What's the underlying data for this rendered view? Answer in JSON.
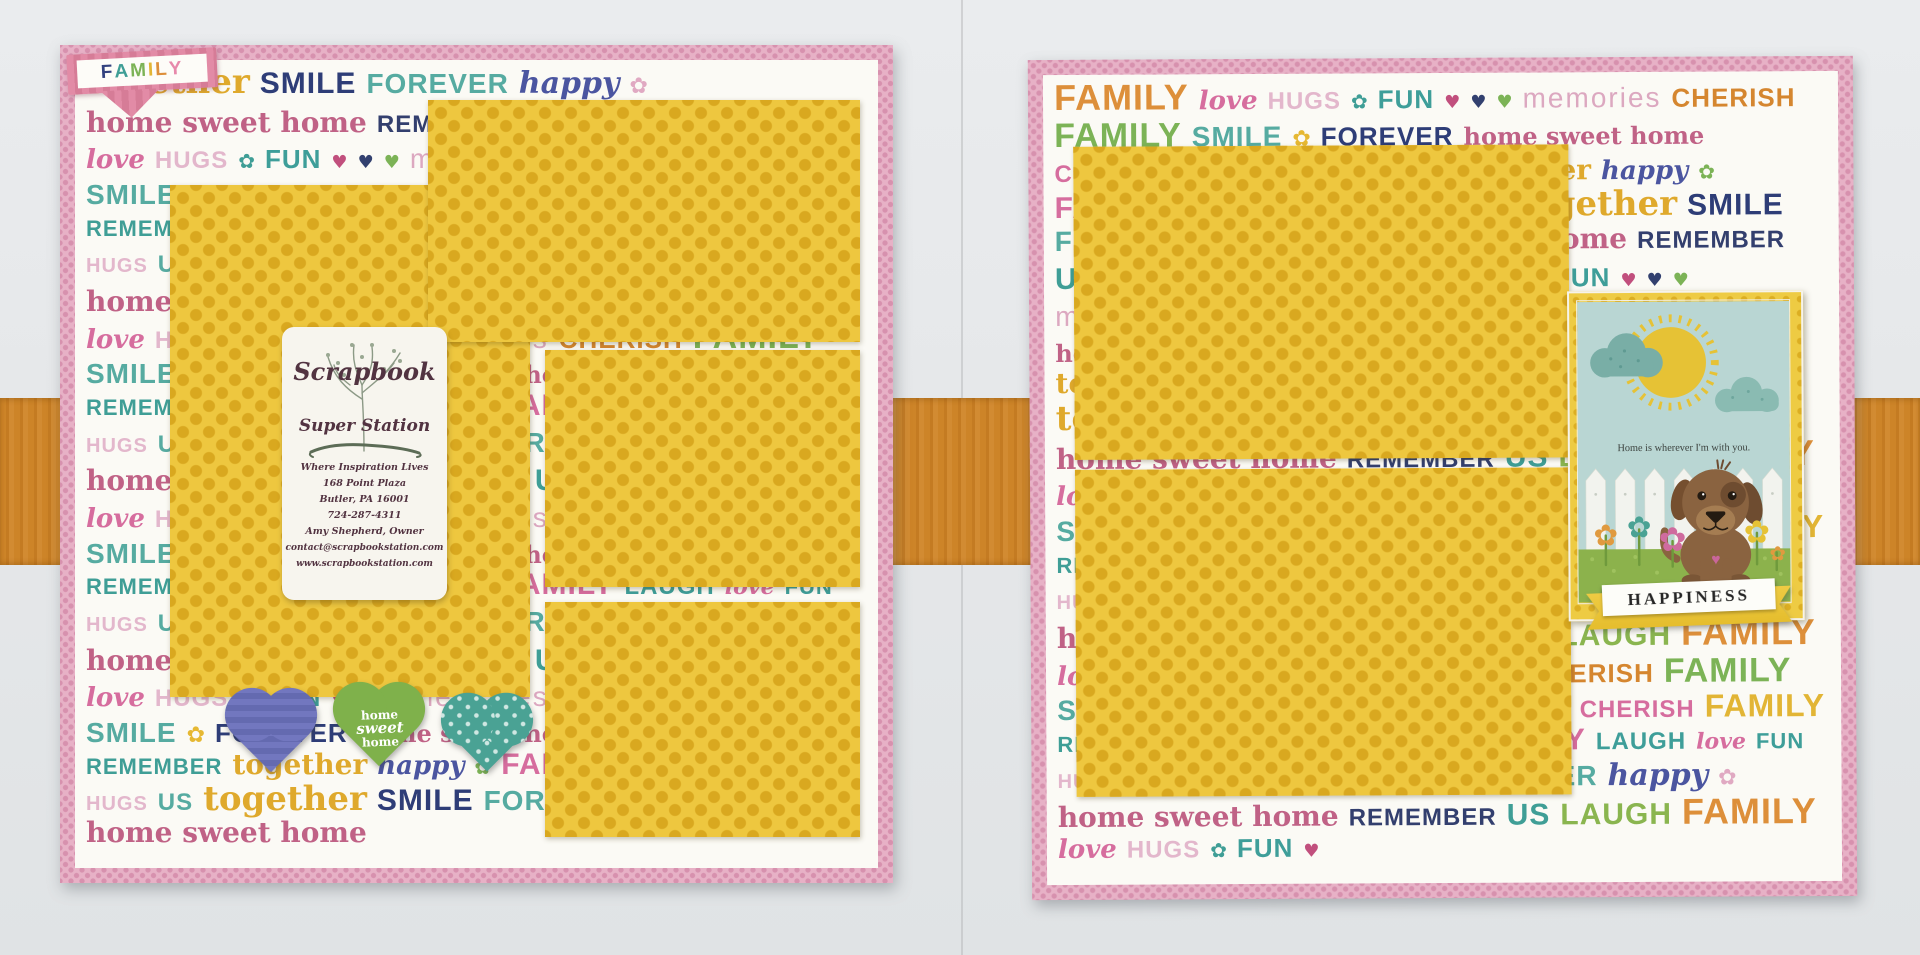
{
  "photo": {
    "background_color": "#e6e8ea",
    "ribbon_color": "#cd8428",
    "page_border_color": "#e7b1c6",
    "mat_color": "#eec73f"
  },
  "icons": {
    "flower_glyph": "✿",
    "heart_glyph": "♥"
  },
  "word_bank": [
    {
      "t": "together",
      "c": "#dfa92c",
      "f": "serifb",
      "sz": 34
    },
    {
      "t": "SMILE",
      "c": "#2e3d77",
      "f": "caps",
      "sz": 30
    },
    {
      "t": "FOREVER",
      "c": "#56aba1",
      "f": "caps",
      "sz": 28
    },
    {
      "t": "happy",
      "c": "#4b55a0",
      "f": "script",
      "sz": 30
    },
    {
      "t": "✿",
      "c": "#e0a9c2",
      "f": "glyph",
      "sz": 22
    },
    {
      "t": "home sweet home",
      "c": "#c06286",
      "f": "serifb",
      "sz": 28
    },
    {
      "t": "REMEMBER",
      "c": "#333f6e",
      "f": "caps",
      "sz": 24
    },
    {
      "t": "US",
      "c": "#3f9e96",
      "f": "caps",
      "sz": 30
    },
    {
      "t": "LAUGH",
      "c": "#8ab54f",
      "f": "caps",
      "sz": 30
    },
    {
      "t": "FAMILY",
      "c": "#dd8f3a",
      "f": "caps",
      "sz": 36
    },
    {
      "t": "love",
      "c": "#d66d9e",
      "f": "script",
      "sz": 26
    },
    {
      "t": "HUGS",
      "c": "#e3b7cc",
      "f": "caps",
      "sz": 24
    },
    {
      "t": "✿",
      "c": "#3f9e96",
      "f": "glyph",
      "sz": 20
    },
    {
      "t": "FUN",
      "c": "#3e9e99",
      "f": "caps",
      "sz": 26
    },
    {
      "t": "♥",
      "c": "#c14f7d",
      "f": "glyph",
      "sz": 18
    },
    {
      "t": "♥",
      "c": "#32406f",
      "f": "glyph",
      "sz": 18
    },
    {
      "t": "♥",
      "c": "#7cb356",
      "f": "glyph",
      "sz": 18
    },
    {
      "t": "memories",
      "c": "#dca8c0",
      "f": "lower",
      "sz": 28
    },
    {
      "t": "CHERISH",
      "c": "#d5862f",
      "f": "caps",
      "sz": 26
    },
    {
      "t": "FAMILY",
      "c": "#7cb356",
      "f": "caps",
      "sz": 34
    },
    {
      "t": "SMILE",
      "c": "#56aba1",
      "f": "caps",
      "sz": 28
    },
    {
      "t": "✿",
      "c": "#e6b832",
      "f": "glyph",
      "sz": 22
    },
    {
      "t": "FOREVER",
      "c": "#2e3d77",
      "f": "caps",
      "sz": 26
    },
    {
      "t": "home sweet home",
      "c": "#c06286",
      "f": "serifb",
      "sz": 24
    },
    {
      "t": "CHERISH",
      "c": "#d66d9e",
      "f": "caps",
      "sz": 24
    },
    {
      "t": "FAMILY",
      "c": "#e2b535",
      "f": "caps",
      "sz": 32
    },
    {
      "t": "REMEMBER",
      "c": "#3f9e96",
      "f": "caps",
      "sz": 22
    },
    {
      "t": "together",
      "c": "#dfa92c",
      "f": "serifb",
      "sz": 28
    },
    {
      "t": "happy",
      "c": "#4b55a0",
      "f": "script",
      "sz": 26
    },
    {
      "t": "✿",
      "c": "#7cb356",
      "f": "glyph",
      "sz": 20
    },
    {
      "t": "FAMILY",
      "c": "#d66d9e",
      "f": "caps",
      "sz": 30
    },
    {
      "t": "LAUGH",
      "c": "#3e9e99",
      "f": "caps",
      "sz": 24
    },
    {
      "t": "love",
      "c": "#d66d9e",
      "f": "script",
      "sz": 22
    },
    {
      "t": "FUN",
      "c": "#3e9e99",
      "f": "caps",
      "sz": 22
    },
    {
      "t": "HUGS",
      "c": "#e3b7cc",
      "f": "caps",
      "sz": 20
    },
    {
      "t": "US",
      "c": "#56aba1",
      "f": "caps",
      "sz": 24
    }
  ],
  "left_page": {
    "corner_banner": {
      "word": "FAMILY",
      "letter_colors": [
        "#33427f",
        "#3f9e96",
        "#7cb356",
        "#e2b535",
        "#dd8f3a",
        "#e789ab"
      ]
    },
    "business_card": {
      "title_line1": "Scrapbook",
      "title_line2": "Super Station",
      "tagline": "Where Inspiration Lives",
      "address_line1": "168 Point Plaza",
      "address_line2": "Butler, PA 16001",
      "phone": "724-287-4311",
      "owner": "Amy Shepherd, Owner",
      "email": "contact@scrapbookstation.com",
      "website": "www.scrapbookstation.com"
    },
    "green_heart_text": {
      "line1": "home",
      "line2": "sweet",
      "line3": "home"
    }
  },
  "right_page": {
    "scene_card": {
      "message": "Home is wherever I'm with you."
    },
    "happiness_banner": "HAPPINESS"
  }
}
